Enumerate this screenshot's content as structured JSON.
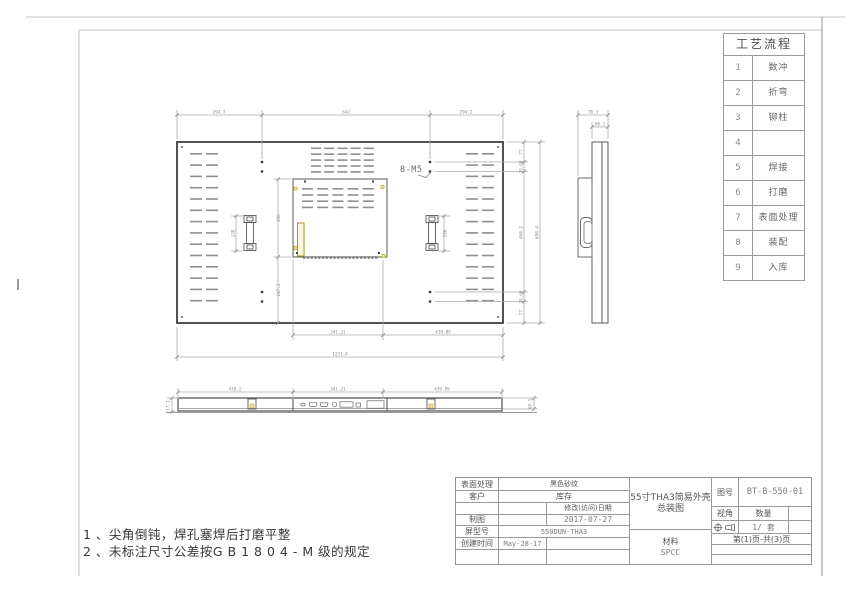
{
  "process_table": {
    "title": "工艺流程",
    "rows": [
      {
        "num": "1",
        "name": "数冲"
      },
      {
        "num": "2",
        "name": "折弯"
      },
      {
        "num": "3",
        "name": "铆柱"
      },
      {
        "num": "4",
        "name": ""
      },
      {
        "num": "5",
        "name": "焊接"
      },
      {
        "num": "6",
        "name": "打磨"
      },
      {
        "num": "7",
        "name": "表面处理"
      },
      {
        "num": "8",
        "name": "装配"
      },
      {
        "num": "9",
        "name": "入库"
      }
    ]
  },
  "notes": {
    "line1": "1 、尖角倒钝，焊孔塞焊后打磨平整",
    "line2": "2 、未标注尺寸公差按G B 1 8 0 4 - M 级的规定"
  },
  "dims": {
    "main_top": [
      "294.7",
      "642",
      "294.2"
    ],
    "main_bottom": [
      "341.21",
      "439.89"
    ],
    "main_total_width": "1231.4",
    "main_right": [
      "77",
      "39.68",
      "468.2",
      "39.68",
      "77"
    ],
    "main_total_height": "698.4",
    "inner_height": "250",
    "inner_offset": "247.2",
    "bracket_left": "128",
    "bracket_right": "128",
    "thread_callout": "8-M5",
    "side_outer": "78.3",
    "side_inner": "68.1",
    "bottom_view": [
      "439.2",
      "341.21",
      "439.89"
    ],
    "bottom_left_height": "17.1",
    "bottom_right_height": "68.1"
  },
  "title_block": {
    "surface_label": "表面处理",
    "surface_value": "黑色砂纹",
    "customer_label": "客户",
    "customer_value": "库存",
    "modify_date_label": "修改(访问)日期",
    "draft_label": "制图",
    "draft_value": "2017-07-27",
    "model_label": "屏型号",
    "model_value": "550DUN-THA3",
    "create_label": "创建时间",
    "create_value": "May-28-17",
    "title_line1": "55寸THA3简易外壳",
    "title_line2": "总装图",
    "material_label": "材料",
    "material_value": "SPCC",
    "drawing_no_label": "图号",
    "drawing_no_value": "BT-B-550-01",
    "view_label": "视角",
    "qty_label": "数量",
    "qty_value": "1/ 套",
    "page_text": "第(1)页-共(3)页"
  }
}
